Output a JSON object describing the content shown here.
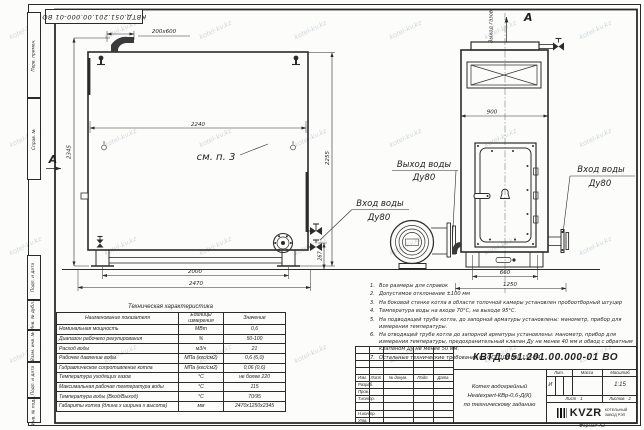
{
  "watermark": "kotel-kv.kz",
  "frame": {
    "top_stamp": "КВТД.051.201.00.000-01 ВО",
    "margin_boxes": [
      {
        "label": "Перв. примен."
      },
      {
        "label": "Справ. №"
      },
      {
        "label": "Подп. и дата"
      },
      {
        "label": "Инв. № дубл."
      },
      {
        "label": "Взам. инв. №"
      },
      {
        "label": "Подп. и дата"
      },
      {
        "label": "Инв. № подл."
      }
    ],
    "format_note": "Формат А3"
  },
  "views": {
    "side": {
      "section_arrow": "А",
      "flue_dim": "200х600",
      "dim_width_inner": "2240",
      "dim_height_total": "2345",
      "dim_height_body": "2255",
      "dim_flange_height": "267",
      "dim_supports": "2000",
      "dim_length": "2470",
      "see_note": "см. п. 3",
      "inlet_label_1": "Вход воды",
      "inlet_label_2": "Ду80"
    },
    "front": {
      "section_arrow": "А",
      "gas_outlet_label": "Выход газов",
      "dim_width_top": "900",
      "dim_door": "660",
      "dim_base": "1250",
      "outlet_label_1": "Выход воды",
      "outlet_label_2": "Ду80",
      "inlet_label_1": "Вход воды",
      "inlet_label_2": "Ду80"
    }
  },
  "tech_table": {
    "title": "Техническая характеристика",
    "headers": [
      "Наименование показателя",
      "Единицы измерения",
      "Значение"
    ],
    "rows": [
      [
        "Номинальная мощность",
        "МВт",
        "0,6"
      ],
      [
        "Диапазон рабочего регулирования",
        "%",
        "50-100"
      ],
      [
        "Расход воды",
        "м3/ч",
        "21"
      ],
      [
        "Рабочее давление воды",
        "МПа (кгс/см2)",
        "0,6 (6,0)"
      ],
      [
        "Гидравлическое сопротивление котла",
        "МПа (кгс/см2)",
        "0,06 (0,6)"
      ],
      [
        "Температура уходящих газов",
        "°С",
        "не более 220"
      ],
      [
        "Максимальная рабочая температура воды",
        "°С",
        "115"
      ],
      [
        "Температура воды (Вход/Выход)",
        "°С",
        "70/95"
      ],
      [
        "Габариты котла (длина х ширина х высота)",
        "мм",
        "2470х1250х2345"
      ]
    ]
  },
  "notes": [
    {
      "n": "1.",
      "text": "Все размеры для справок"
    },
    {
      "n": "2.",
      "text": "Допустимое отклонение ±100 мм"
    },
    {
      "n": "3.",
      "text": "На боковой стенке котла в области топочной камеры установлен пробоотборный штуцер"
    },
    {
      "n": "4.",
      "text": "Температура воды на входе 70°С, на выходе 95°С."
    },
    {
      "n": "5.",
      "text": "На подводящей трубе котла, до запорной арматуры установлены: манометр, прибор для измерения температуры."
    },
    {
      "n": "6.",
      "text": "На отводящей трубе котла до запорной арматуры установлены: манометр, прибор для измерения температуры, предохранительный клапан Ду не менее 40 мм и обвод с обратным клапаном Ду не менее 50 мм."
    },
    {
      "n": "7.",
      "text": "Остальные технические требования по ОСТ 108.030.133-84"
    }
  ],
  "title_block": {
    "doc_number": "КВТД.051.201.00.000-01 ВО",
    "product_line1": "Котел водогрейный",
    "product_line2": "Heatexpert-КВр-0,6-Д(К)",
    "product_line3": "по техническому заданию",
    "col_izm": "Изм.",
    "col_list": "Лист",
    "col_doc": "№ докум.",
    "col_podp": "Подп.",
    "col_data": "Дата",
    "row_razrab": "Разраб.",
    "row_prov": "Пров.",
    "row_tkontr": "Т.контр.",
    "row_nkontr": "Н.контр.",
    "row_utv": "Утв.",
    "lit_header": "Лит.",
    "mass_header": "Масса",
    "scale_header": "Масштаб",
    "lit_value": "И",
    "scale_value": "1:15",
    "sheet_label": "Лист",
    "sheet_value": "1",
    "sheets_label": "Листов",
    "sheets_value": "2",
    "logo_text": "KVZR",
    "company_line1": "КОТЕЛЬНЫЙ",
    "company_line2": "ЗАВОД РЭП"
  }
}
